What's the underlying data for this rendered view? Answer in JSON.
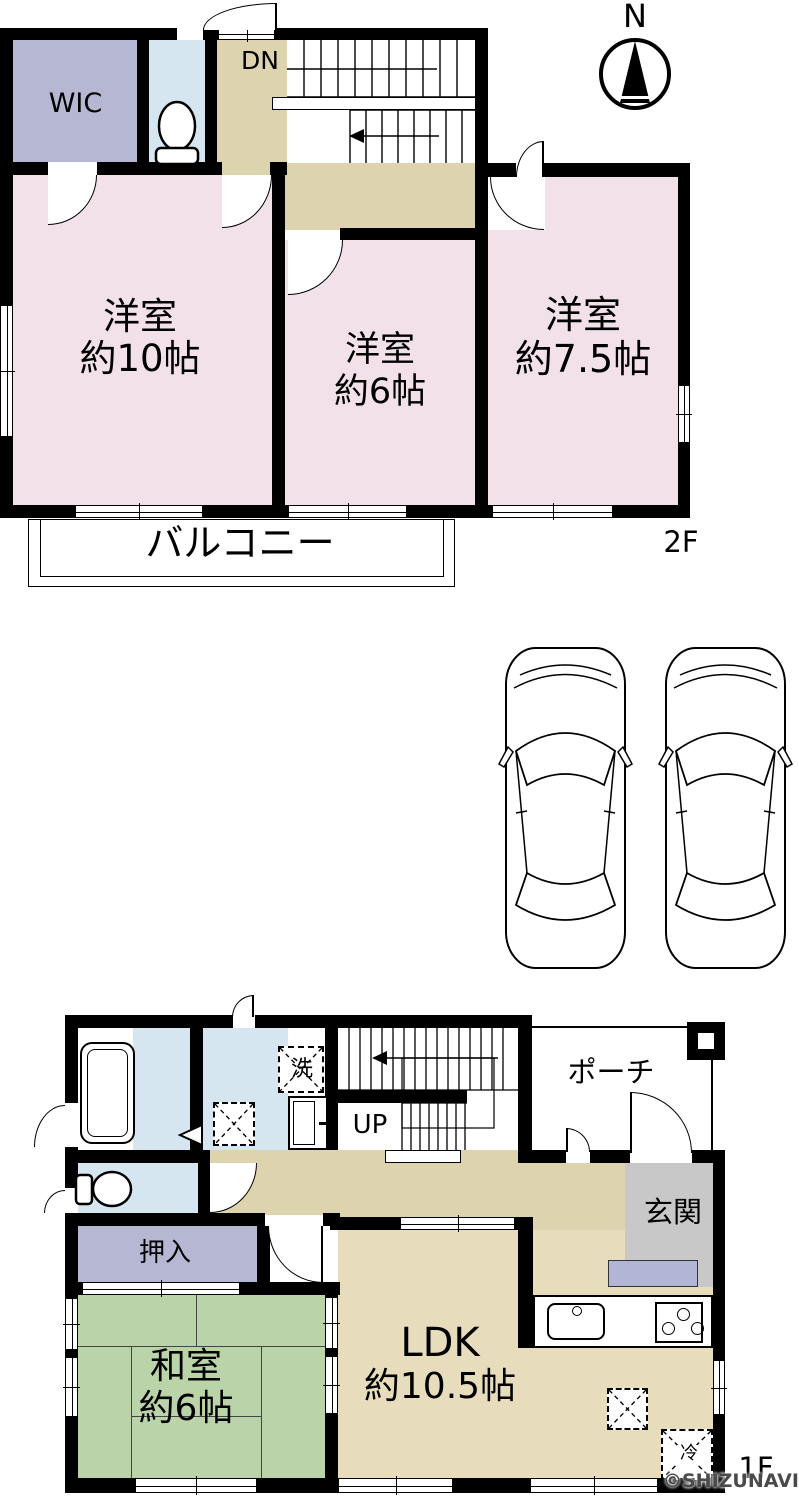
{
  "compass": {
    "north": "N"
  },
  "watermark": "©SHIZUNAVI",
  "floor_2f": {
    "label": "2F",
    "wic": "WIC",
    "stairs": "DN",
    "bedroom_10": {
      "name": "洋室",
      "size": "約10帖"
    },
    "bedroom_6": {
      "name": "洋室",
      "size": "約6帖"
    },
    "bedroom_7_5": {
      "name": "洋室",
      "size": "約7.5帖"
    },
    "balcony": "バルコニー"
  },
  "floor_1f": {
    "label": "1F",
    "stairs": "UP",
    "washer": "洗",
    "porch": "ポーチ",
    "entrance": "玄関",
    "closet": "押入",
    "japanese_room": {
      "name": "和室",
      "size": "約6帖"
    },
    "ldk": {
      "name": "LDK",
      "size": "約10.5帖"
    },
    "fridge": "冷"
  }
}
